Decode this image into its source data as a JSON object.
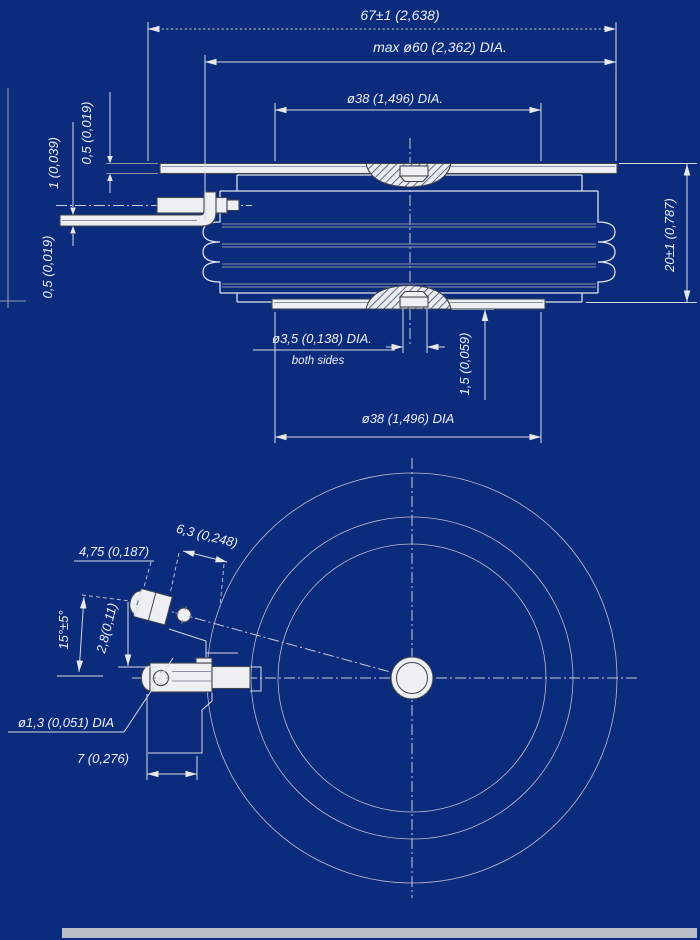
{
  "colors": {
    "background": "#0b2b7d",
    "line": "#d9dde3",
    "object_fill": "#edeff2",
    "hatch": "#32406e",
    "text": "#eef0f4",
    "scan_band": "#b9bec8"
  },
  "drawing_type": "semiconductor-disc-package-outline",
  "side_view": {
    "dims": {
      "overall_width": "67±1 (2,638)",
      "max_body_dia": "max ø60 (2,362) DIA.",
      "top_contact_dia": "ø38 (1,496) DIA.",
      "height": "20±1 (0,787)",
      "top_tab_thickness": "0,5 (0,019)",
      "tab_spacing": "1 (0,039)",
      "bottom_tab_thickness": "0,5 (0,019)",
      "center_recess_dia": "ø3,5 (0,138) DIA.",
      "center_recess_note": "both sides",
      "recess_depth": "1,5 (0,059)",
      "bottom_contact_dia": "ø38 (1,496) DIA"
    }
  },
  "bottom_view": {
    "dims": {
      "gate_terminal_width": "4,75 (0,187)",
      "gate_terminal_length": "6,3 (0,248)",
      "gate_angle": "15°±5°",
      "gate_offset": "2,8(0,11)",
      "gate_pin_dia": "ø1,3 (0,051) DIA",
      "gate_pin_distance": "7 (0,276)"
    }
  }
}
